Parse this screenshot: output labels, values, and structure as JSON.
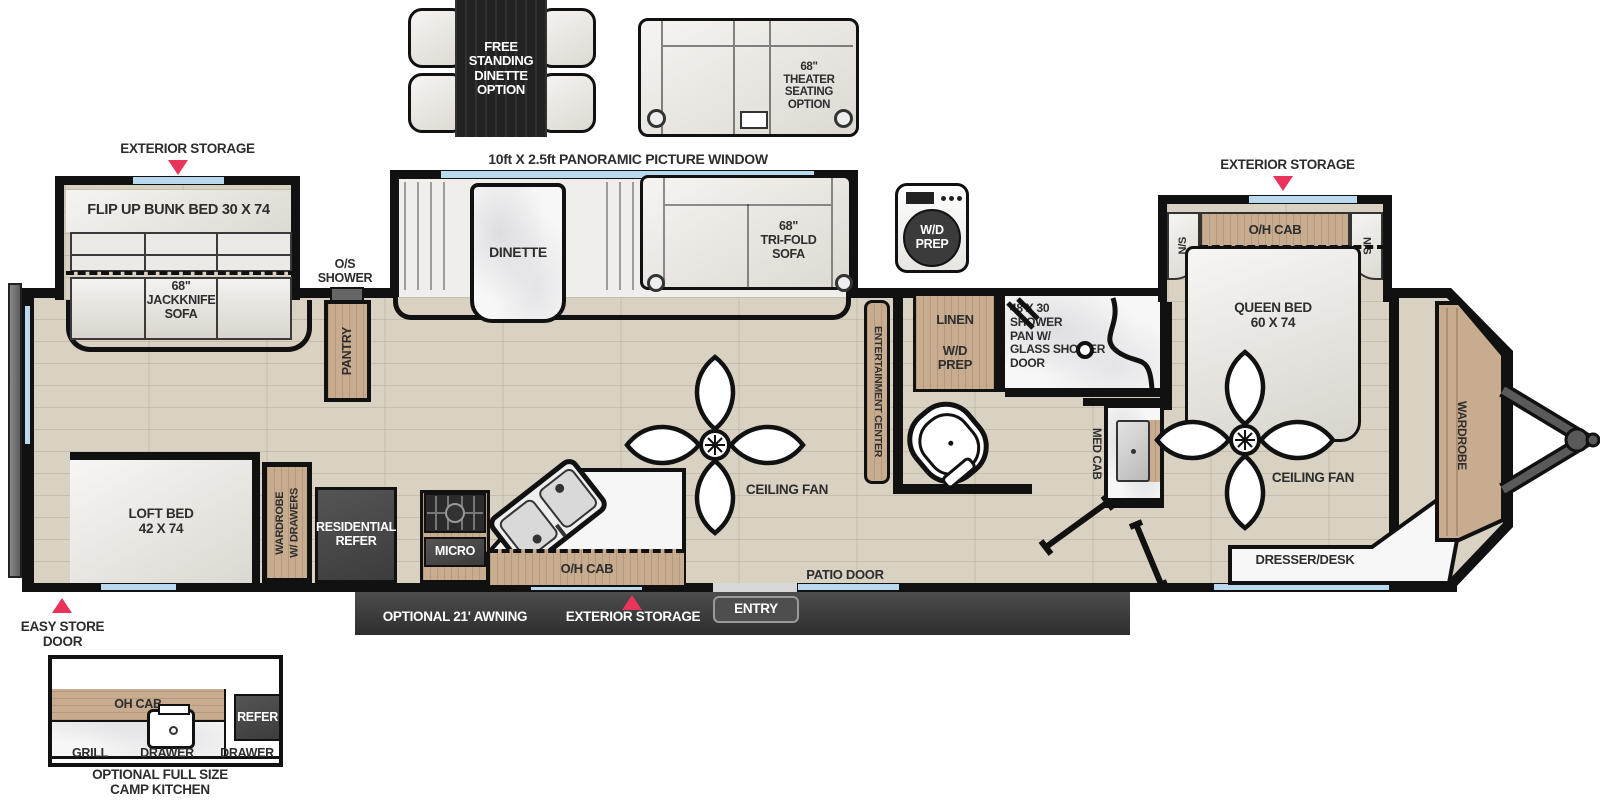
{
  "colors": {
    "accent_red": "#E8335A",
    "window_blue": "#B9D9EF",
    "wall_black": "#111111",
    "cabinet_wood": "#C8AC90",
    "appliance_dark": "#474747",
    "floor_wood": "#D9D2C2"
  },
  "top_options": {
    "dinette_label": "FREE\nSTANDING\nDINETTE\nOPTION",
    "theater_label": "68\"\nTHEATER\nSEATING\nOPTION"
  },
  "window_callout": "10ft X 2.5ft PANORAMIC PICTURE WINDOW",
  "callouts": {
    "exterior_storage_rear": "EXTERIOR STORAGE",
    "exterior_storage_front": "EXTERIOR STORAGE",
    "exterior_storage_bottom": "EXTERIOR STORAGE",
    "easy_store_door": "EASY STORE DOOR",
    "awning": "OPTIONAL 21' AWNING",
    "patio_door": "PATIO DOOR",
    "entry": "ENTRY",
    "os_shower": "O/S\nSHOWER"
  },
  "rear_bedroom": {
    "bunk": "FLIP UP BUNK BED 30 X 74",
    "jackknife_sofa": "68\"\nJACKKNIFE\nSOFA",
    "loft_bed": "LOFT BED\n42 X 74",
    "wardrobe": "WARDROBE\nW/ DRAWERS",
    "pantry": "PANTRY"
  },
  "kitchen": {
    "refer": "RESIDENTIAL\nREFER",
    "micro": "MICRO",
    "oh_cab": "O/H CAB"
  },
  "living": {
    "dinette": "DINETTE",
    "sofa": "68\"\nTRI-FOLD\nSOFA",
    "ceiling_fan": "CEILING FAN",
    "entertainment": "ENTERTAINMENT CENTER"
  },
  "bath": {
    "wd_icon": "W/D\nPREP",
    "linen": "LINEN",
    "wd_prep": "W/D\nPREP",
    "shower": "48 X 30\nSHOWER\nPAN W/\nGLASS SHOWER\nDOOR",
    "med_cab": "MED CAB"
  },
  "front_bedroom": {
    "oh_cab": "O/H CAB",
    "ns_left": "N/S",
    "ns_right": "N/S",
    "queen": "QUEEN BED\n60 X 74",
    "wardrobe": "WARDROBE",
    "ceiling_fan": "CEILING FAN",
    "dresser": "DRESSER/DESK"
  },
  "camp_kitchen": {
    "oh_cab": "OH CAB",
    "refer": "REFER",
    "grill": "GRILL",
    "drawer_1": "DRAWER",
    "drawer_2": "DRAWER",
    "caption": "OPTIONAL FULL SIZE\nCAMP KITCHEN"
  }
}
